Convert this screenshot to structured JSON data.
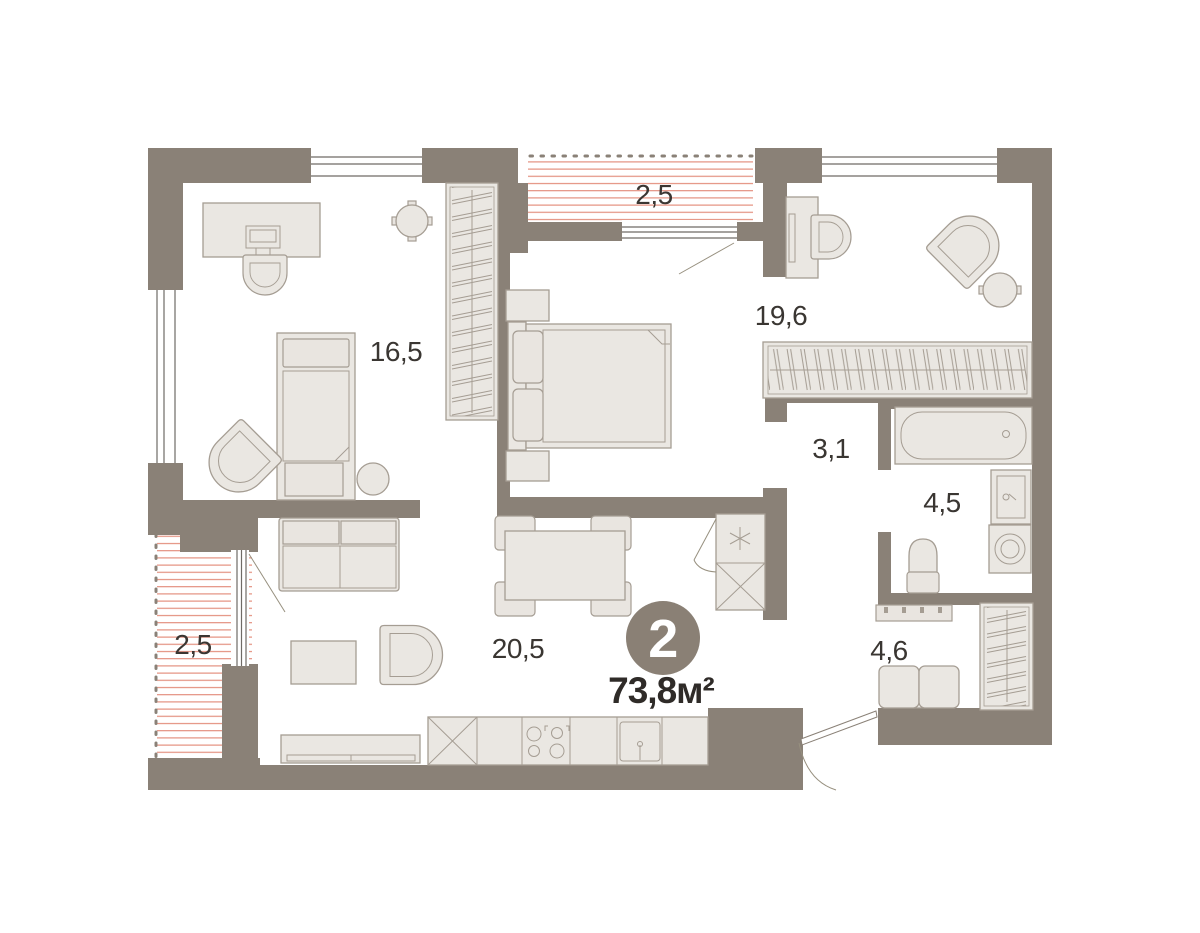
{
  "plan": {
    "badge": {
      "room_count": "2",
      "total_area": "73,8м²"
    },
    "room_labels": {
      "room1": "16,5",
      "bedroom": "19,6",
      "balcony_top": "2,5",
      "corridor": "3,1",
      "bathroom": "4,5",
      "hallway": "4,6",
      "living_kitchen": "20,5",
      "balcony_left": "2,5"
    },
    "colors": {
      "wall": "#8a8177",
      "furniture_fill": "#eae7e2",
      "furniture_stroke": "#a59d93",
      "balcony_hatch": "#e4907f",
      "badge_fill": "#8a8075",
      "label_text": "#3a3632",
      "background": "#ffffff"
    }
  }
}
